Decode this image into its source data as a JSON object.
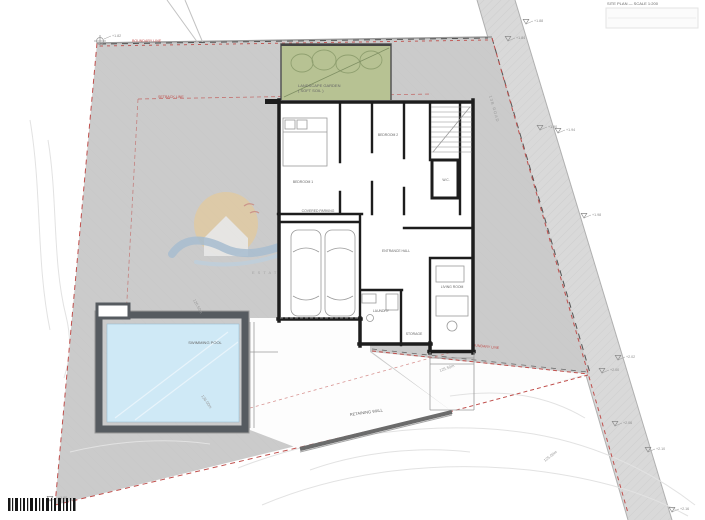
{
  "labels": {
    "corner_note": "SITE PLAN — SCALE 1:200",
    "boundary_top": "BOUNDARY LINE",
    "setback": "SETBACK LINE",
    "boundary_bottom": "BOUNDARY LINE",
    "garden_line1": "LANDSCAPE GARDEN",
    "garden_line2": "( SOFT SOIL )",
    "pool": "SWIMMING POOL",
    "road": "13B ROAD",
    "retaining_wall": "RETAINING WALL",
    "watermark": "ESTATES"
  },
  "rooms": [
    {
      "label": "BEDROOM 1"
    },
    {
      "label": "BEDROOM 2"
    },
    {
      "label": "W.C."
    },
    {
      "label": "COVERED PARKING"
    },
    {
      "label": "ENTRANCE HALL"
    },
    {
      "label": "LAUNDRY"
    },
    {
      "label": "STORAGE"
    },
    {
      "label": "LIVING ROOM"
    }
  ],
  "levels": [
    {
      "value": "+1.82"
    },
    {
      "value": "+1.88"
    },
    {
      "value": "+1.84"
    },
    {
      "value": "+1.90"
    },
    {
      "value": "+1.94"
    },
    {
      "value": "+1.98"
    },
    {
      "value": "+2.00"
    },
    {
      "value": "+2.02"
    },
    {
      "value": "+2.06"
    },
    {
      "value": "+2.10"
    },
    {
      "value": "+2.16"
    },
    {
      "value": "+1.80"
    }
  ],
  "contours": [
    {
      "label": "126.50m"
    },
    {
      "label": "126.00m"
    },
    {
      "label": "125.50m"
    },
    {
      "label": "125.00m"
    }
  ],
  "colors": {
    "site": "#cbcbcb",
    "road": "#d9d9d9",
    "water": "#cfe9f6",
    "garden": "#b7c293",
    "red": "#c0504d",
    "wall": "#1d1d1d",
    "sun": "#f4c87c",
    "wave": "#8ab2d4"
  }
}
